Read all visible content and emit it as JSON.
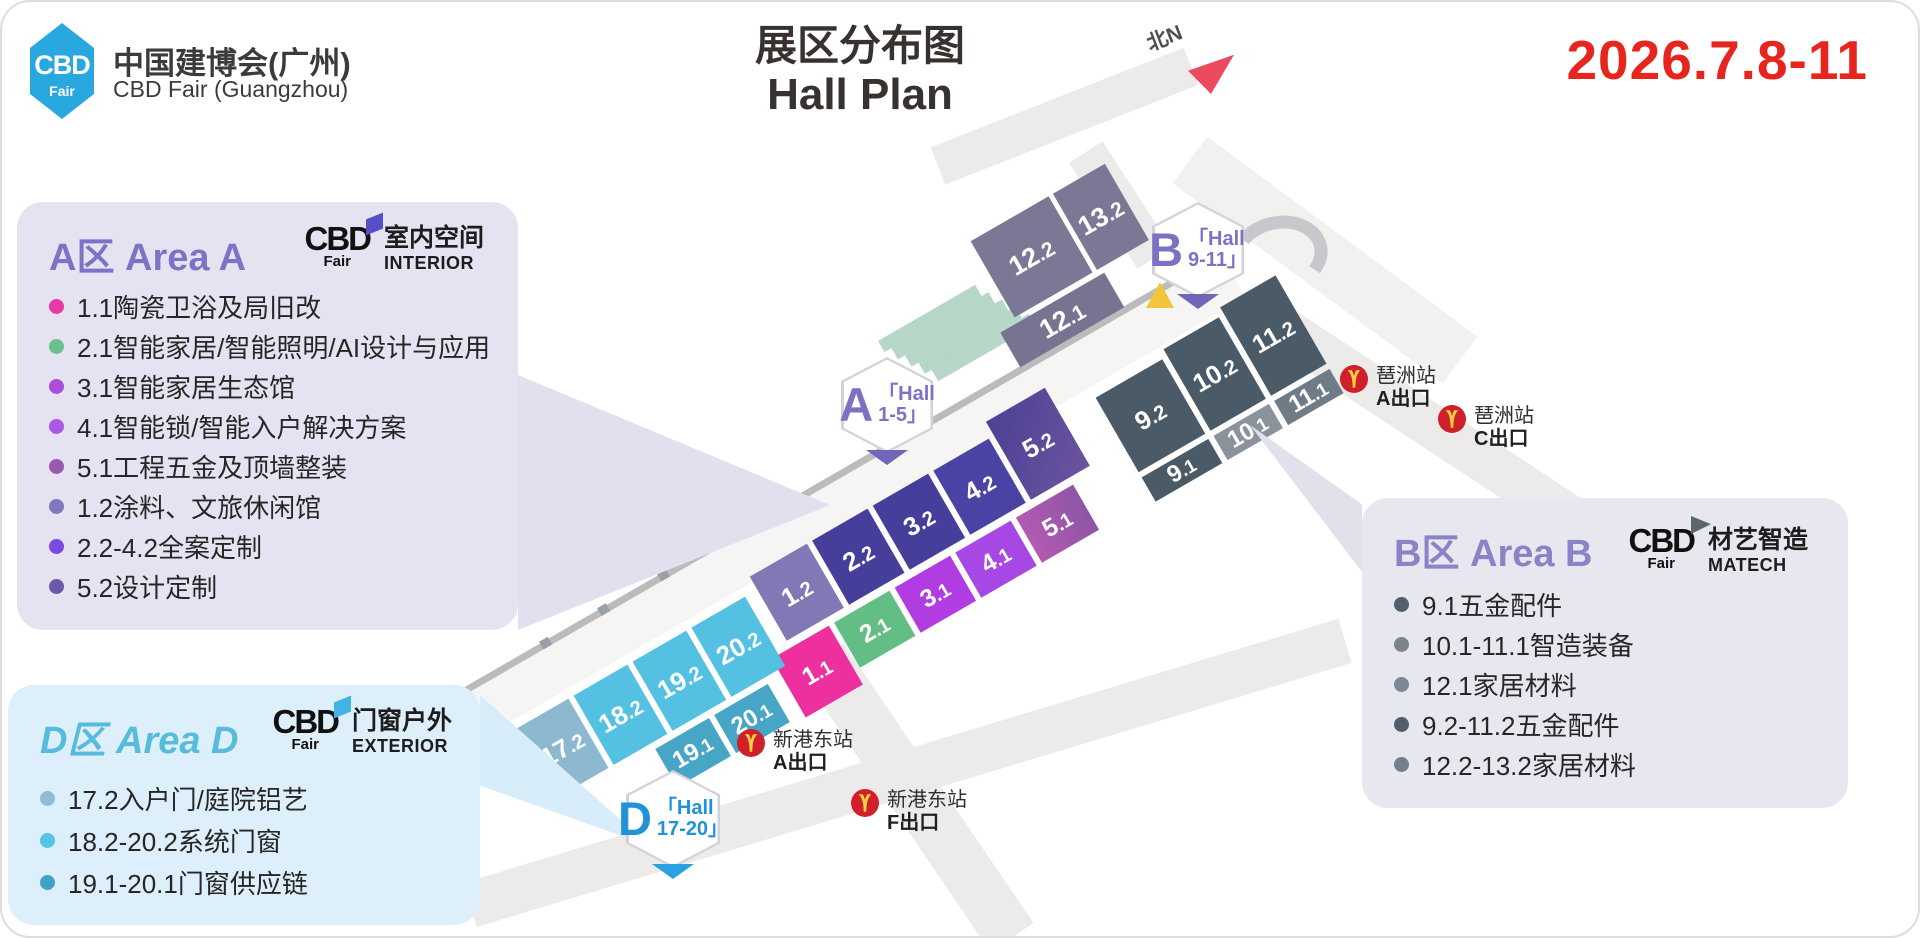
{
  "header": {
    "logo_cbd": "CBD",
    "logo_fair": "Fair",
    "brand_cn": "中国建博会(广州)",
    "brand_en": "CBD Fair (Guangzhou)",
    "title_cn": "展区分布图",
    "title_en": "Hall Plan",
    "date": "2026.7.8-11",
    "north_label": "北N"
  },
  "colors": {
    "brand_blue": "#29a8e0",
    "date_red": "#e6251f",
    "area_a_purple": "#7b74c6",
    "area_b_purple": "#8a83c5",
    "area_d_blue": "#56bbdc",
    "metro_red": "#d0202c",
    "metro_yellow": "#ffd23e",
    "flag_a": "#554fc8",
    "flag_b": "#5b6670",
    "flag_d": "#42b4e4"
  },
  "panel_a": {
    "title": "A区 Area A",
    "logo": {
      "cbd": "CBD",
      "fair": "Fair",
      "name_cn": "室内空间",
      "name_en": "INTERIOR"
    },
    "items": [
      {
        "color": "#e83aa6",
        "text": "1.1陶瓷卫浴及局旧改"
      },
      {
        "color": "#6bc08c",
        "text": "2.1智能家居/智能照明/AI设计与应用"
      },
      {
        "color": "#a94fd8",
        "text": "3.1智能家居生态馆"
      },
      {
        "color": "#ab58e8",
        "text": "4.1智能锁/智能入户解决方案"
      },
      {
        "color": "#9a5bae",
        "text": "5.1工程五金及顶墙整装"
      },
      {
        "color": "#7d78bf",
        "text": "1.2涂料、文旅休闲馆"
      },
      {
        "color": "#7a4ae4",
        "text": "2.2-4.2全案定制"
      },
      {
        "color": "#6d57a8",
        "text": "5.2设计定制"
      }
    ]
  },
  "panel_b": {
    "title": "B区 Area B",
    "logo": {
      "cbd": "CBD",
      "fair": "Fair",
      "name_cn": "材艺智造",
      "name_en": "MATECH"
    },
    "items": [
      {
        "color": "#50606d",
        "text": "9.1五金配件"
      },
      {
        "color": "#7b848d",
        "text": "10.1-11.1智造装备"
      },
      {
        "color": "#7d8795",
        "text": "12.1家居材料"
      },
      {
        "color": "#4f5f6c",
        "text": "9.2-11.2五金配件"
      },
      {
        "color": "#737f8c",
        "text": "12.2-13.2家居材料"
      }
    ]
  },
  "panel_d": {
    "title": "D区 Area D",
    "logo": {
      "cbd": "CBD",
      "fair": "Fair",
      "name_cn": "门窗户外",
      "name_en": "EXTERIOR"
    },
    "items": [
      {
        "color": "#8fbed2",
        "text": "17.2入户门/庭院铝艺"
      },
      {
        "color": "#57c3e6",
        "text": "18.2-20.2系统门窗"
      },
      {
        "color": "#3fa3c8",
        "text": "19.1-20.1门窗供应链"
      }
    ]
  },
  "badges": {
    "a": {
      "letter": "A",
      "line1": "「Hall",
      "line2": "1-5」"
    },
    "b": {
      "letter": "B",
      "line1": "「Hall",
      "line2": "9-11」"
    },
    "d": {
      "letter": "D",
      "line1": "「Hall",
      "line2": "17-20」"
    }
  },
  "stations": [
    {
      "name": "琶洲站",
      "exit": "A出口"
    },
    {
      "name": "琶洲站",
      "exit": "C出口"
    },
    {
      "name": "新港东站",
      "exit": "A出口"
    },
    {
      "name": "新港东站",
      "exit": "F出口"
    }
  ],
  "map": {
    "halls": {
      "h1_1": "1.1",
      "h2_1": "2.1",
      "h3_1": "3.1",
      "h4_1": "4.1",
      "h5_1": "5.1",
      "h1_2": "1.2",
      "h2_2": "2.2",
      "h3_2": "3.2",
      "h4_2": "4.2",
      "h5_2": "5.2",
      "h9_1": "9.1",
      "h9_2": "9.2",
      "h10_1": "10.1",
      "h10_2": "10.2",
      "h11_1": "11.1",
      "h11_2": "11.2",
      "h12_1": "12.1",
      "h12_2": "12.2",
      "h13_2": "13.2",
      "h17_2": "17.2",
      "h18_2": "18.2",
      "h19_1": "19.1",
      "h19_2": "19.2",
      "h20_1": "20.1",
      "h20_2": "20.2"
    },
    "hall_colors": {
      "h1_1": "#ee2f9e",
      "h2_1": "#63be85",
      "h3_1": "#b13ce2",
      "h4_1": "#a848e4",
      "h5_1": "linear-gradient(to right,#b35ab2,#8f55a5)",
      "h1_2": "#8179b5",
      "h2_2": "#453f9b",
      "h3_2": "#453f9b",
      "h4_2": "#4a43a4",
      "h5_2": "linear-gradient(135deg,#4e4096,#6a549e)",
      "h9_1": "#4a5a66",
      "h9_2": "#4a5a66",
      "h10_1": "#8a929b",
      "h10_2": "#4a5a66",
      "h11_1": "#6f7b86",
      "h11_2": "#4a5a66",
      "h12_1": "#777492",
      "h12_2": "#7b7896",
      "h13_2": "#7b7896",
      "h17_2": "#8cb9cf",
      "h18_2": "#55c1e2",
      "h19_2": "#55c1e2",
      "h20_2": "#55c1e2",
      "h19_1": "#47a6c6",
      "h20_1": "#47a6c6"
    }
  }
}
